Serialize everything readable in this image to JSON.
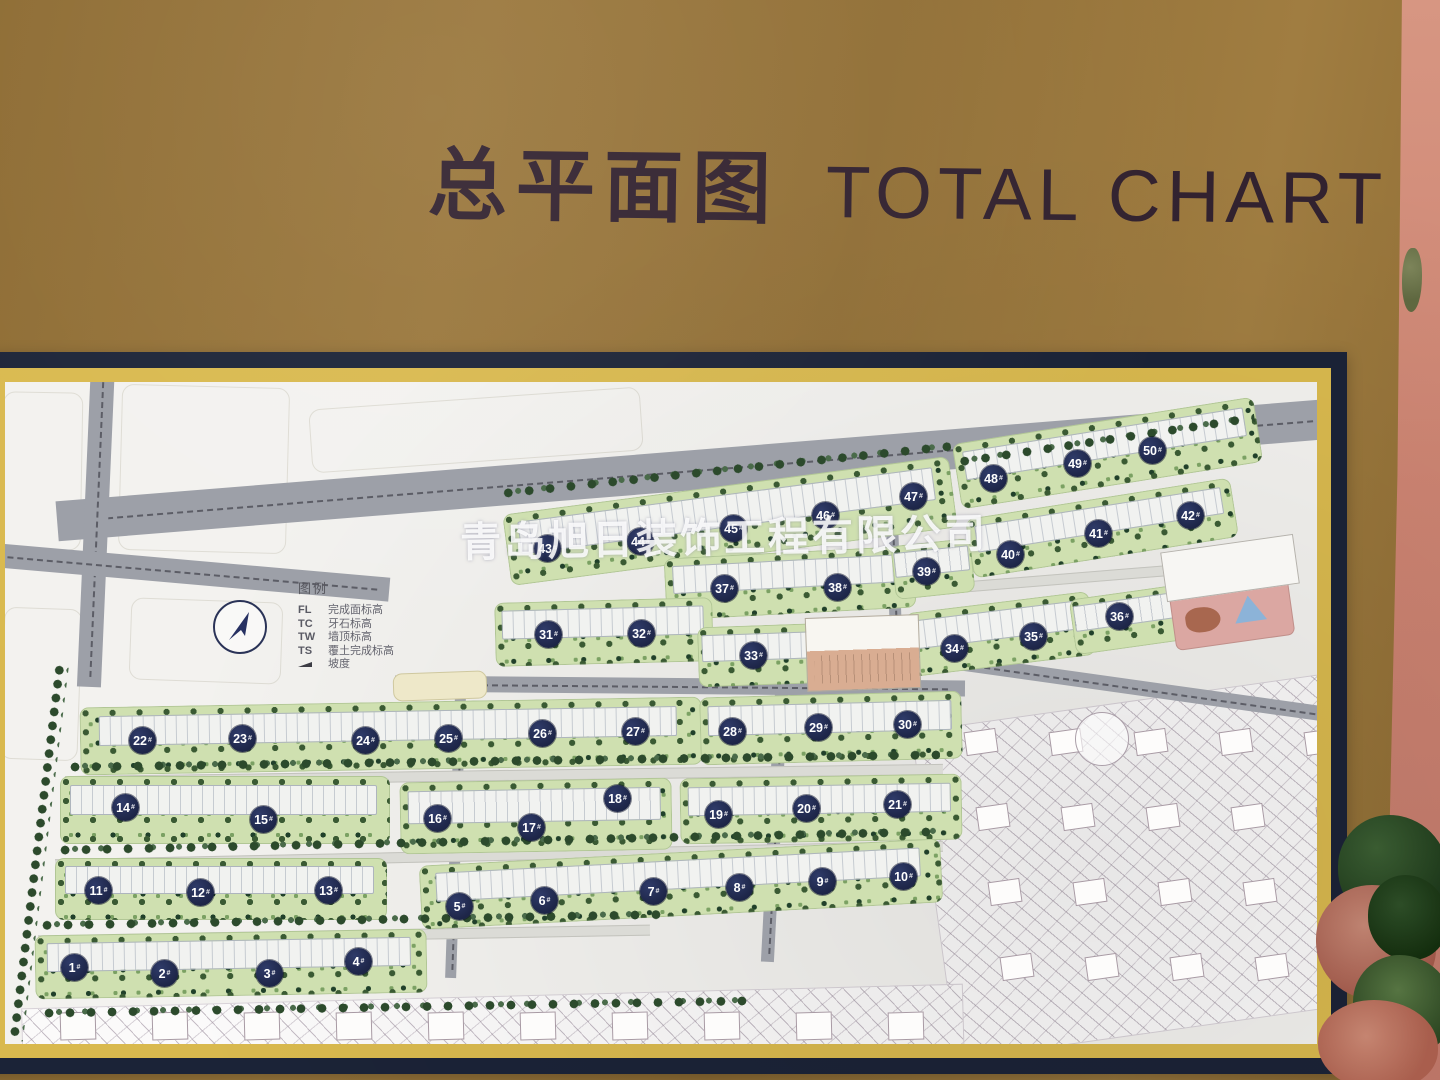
{
  "title": {
    "zh": "总平面图",
    "en": "TOTAL CHART"
  },
  "watermark": {
    "text": "青岛旭日装饰工程有限公司"
  },
  "legend": {
    "title": "图例",
    "items": [
      {
        "key": "FL",
        "label": "完成面标高"
      },
      {
        "key": "TC",
        "label": "牙石标高"
      },
      {
        "key": "TW",
        "label": "墙顶标高"
      },
      {
        "key": "TS",
        "label": "覆土完成标高"
      },
      {
        "key": "",
        "label": "坡度"
      }
    ]
  },
  "colors": {
    "board_gold": "#97743a",
    "frame_navy": "#1b2337",
    "frame_gold": "#d9b94e",
    "map_background": "#f3f2ef",
    "road_gray": "#9da0a8",
    "green_block": "#cfe0b0",
    "tree_dark": "#2c4a2c",
    "badge_navy": "#222b52",
    "badge_text": "#ffffff",
    "wall_pink": "#cd8472",
    "watermark": "#ffffff"
  },
  "map": {
    "origin": {
      "x": 5,
      "y": 382
    },
    "badge_suffix": "#",
    "badges": [
      {
        "n": 1,
        "x": 74,
        "y": 967
      },
      {
        "n": 2,
        "x": 164,
        "y": 973
      },
      {
        "n": 3,
        "x": 269,
        "y": 973
      },
      {
        "n": 4,
        "x": 358,
        "y": 961
      },
      {
        "n": 5,
        "x": 459,
        "y": 906
      },
      {
        "n": 6,
        "x": 544,
        "y": 900
      },
      {
        "n": 7,
        "x": 653,
        "y": 891
      },
      {
        "n": 8,
        "x": 739,
        "y": 887
      },
      {
        "n": 9,
        "x": 822,
        "y": 881
      },
      {
        "n": 10,
        "x": 903,
        "y": 876
      },
      {
        "n": 11,
        "x": 98,
        "y": 890
      },
      {
        "n": 12,
        "x": 200,
        "y": 892
      },
      {
        "n": 13,
        "x": 328,
        "y": 890
      },
      {
        "n": 14,
        "x": 125,
        "y": 807
      },
      {
        "n": 15,
        "x": 263,
        "y": 819
      },
      {
        "n": 16,
        "x": 437,
        "y": 818
      },
      {
        "n": 17,
        "x": 531,
        "y": 827
      },
      {
        "n": 18,
        "x": 617,
        "y": 798
      },
      {
        "n": 19,
        "x": 718,
        "y": 814
      },
      {
        "n": 20,
        "x": 806,
        "y": 808
      },
      {
        "n": 21,
        "x": 897,
        "y": 804
      },
      {
        "n": 22,
        "x": 142,
        "y": 740
      },
      {
        "n": 23,
        "x": 242,
        "y": 738
      },
      {
        "n": 24,
        "x": 365,
        "y": 740
      },
      {
        "n": 25,
        "x": 448,
        "y": 738
      },
      {
        "n": 26,
        "x": 542,
        "y": 733
      },
      {
        "n": 27,
        "x": 635,
        "y": 731
      },
      {
        "n": 28,
        "x": 732,
        "y": 731
      },
      {
        "n": 29,
        "x": 818,
        "y": 727
      },
      {
        "n": 30,
        "x": 907,
        "y": 724
      },
      {
        "n": 31,
        "x": 548,
        "y": 634
      },
      {
        "n": 32,
        "x": 641,
        "y": 633
      },
      {
        "n": 33,
        "x": 753,
        "y": 655
      },
      {
        "n": 34,
        "x": 954,
        "y": 648
      },
      {
        "n": 35,
        "x": 1033,
        "y": 636
      },
      {
        "n": 36,
        "x": 1119,
        "y": 616
      },
      {
        "n": 37,
        "x": 724,
        "y": 588
      },
      {
        "n": 38,
        "x": 837,
        "y": 587
      },
      {
        "n": 39,
        "x": 926,
        "y": 571
      },
      {
        "n": 40,
        "x": 1010,
        "y": 554
      },
      {
        "n": 41,
        "x": 1098,
        "y": 533
      },
      {
        "n": 42,
        "x": 1190,
        "y": 515
      },
      {
        "n": 43,
        "x": 547,
        "y": 548
      },
      {
        "n": 44,
        "x": 640,
        "y": 541
      },
      {
        "n": 45,
        "x": 733,
        "y": 528
      },
      {
        "n": 46,
        "x": 825,
        "y": 515
      },
      {
        "n": 47,
        "x": 913,
        "y": 496
      },
      {
        "n": 48,
        "x": 993,
        "y": 478
      },
      {
        "n": 49,
        "x": 1077,
        "y": 463
      },
      {
        "n": 50,
        "x": 1152,
        "y": 450
      }
    ],
    "parcels": [
      {
        "x": 2,
        "y": 392,
        "w": 78,
        "h": 156,
        "r": 1
      },
      {
        "x": 120,
        "y": 386,
        "w": 166,
        "h": 164,
        "r": 1.5
      },
      {
        "x": 2,
        "y": 608,
        "w": 76,
        "h": 150,
        "r": 2
      },
      {
        "x": 130,
        "y": 600,
        "w": 150,
        "h": 80,
        "r": 2
      },
      {
        "x": 310,
        "y": 398,
        "w": 330,
        "h": 62,
        "r": -4
      }
    ],
    "hatch_areas": [
      {
        "x": 932,
        "y": 700,
        "w": 430,
        "h": 330,
        "r": -8
      },
      {
        "x": 22,
        "y": 996,
        "w": 940,
        "h": 80,
        "r": -1.5
      }
    ],
    "hatch_house_grids": [
      {
        "x": 60,
        "y": 1012,
        "cols": 10,
        "rows": 1,
        "dx": 92,
        "dy": 0,
        "row_dx": 0,
        "w": 34,
        "h": 26,
        "r": -1.5
      },
      {
        "x": 965,
        "y": 730,
        "cols": 5,
        "rows": 4,
        "dx": 85,
        "dy": 75,
        "row_dx": 12,
        "w": 30,
        "h": 22,
        "r": -8
      }
    ],
    "circle_features": [
      {
        "x": 1075,
        "y": 712,
        "w": 52,
        "h": 52
      }
    ],
    "roads": [
      {
        "x": 55,
        "y": 448,
        "w": 1330,
        "h": 40,
        "r": -4.6,
        "v": 0
      },
      {
        "x": 84,
        "y": 362,
        "w": 24,
        "h": 325,
        "r": 2.5,
        "v": 1
      },
      {
        "x": -15,
        "y": 560,
        "w": 405,
        "h": 24,
        "r": 5,
        "v": 0
      },
      {
        "x": 395,
        "y": 678,
        "w": 570,
        "h": 16,
        "r": 0.5,
        "v": 0
      },
      {
        "x": 940,
        "y": 682,
        "w": 420,
        "h": 15,
        "r": 8,
        "v": 0
      },
      {
        "x": 768,
        "y": 690,
        "w": 13,
        "h": 272,
        "r": 3,
        "v": 1
      },
      {
        "x": 450,
        "y": 698,
        "w": 11,
        "h": 280,
        "r": 2,
        "v": 1
      },
      {
        "x": 888,
        "y": 472,
        "w": 12,
        "h": 212,
        "r": -2,
        "v": 1
      }
    ],
    "lanes": [
      {
        "x": 65,
        "y": 770,
        "w": 878,
        "h": 9,
        "r": -0.8
      },
      {
        "x": 55,
        "y": 850,
        "w": 888,
        "h": 9,
        "r": -1.2
      },
      {
        "x": 38,
        "y": 930,
        "w": 612,
        "h": 9,
        "r": -1
      },
      {
        "x": 495,
        "y": 589,
        "w": 752,
        "h": 9,
        "r": -4.6
      }
    ],
    "green_blocks": [
      {
        "x": 505,
        "y": 485,
        "w": 450,
        "h": 72,
        "r": -7.5
      },
      {
        "x": 955,
        "y": 420,
        "w": 305,
        "h": 66,
        "r": -9
      },
      {
        "x": 665,
        "y": 552,
        "w": 250,
        "h": 62,
        "r": -3
      },
      {
        "x": 968,
        "y": 498,
        "w": 268,
        "h": 60,
        "r": -9
      },
      {
        "x": 495,
        "y": 600,
        "w": 218,
        "h": 64,
        "r": -1.5
      },
      {
        "x": 698,
        "y": 625,
        "w": 135,
        "h": 60,
        "r": -2
      },
      {
        "x": 908,
        "y": 602,
        "w": 185,
        "h": 64,
        "r": -7
      },
      {
        "x": 1072,
        "y": 592,
        "w": 108,
        "h": 56,
        "r": -8
      },
      {
        "x": 893,
        "y": 542,
        "w": 80,
        "h": 54,
        "r": -6
      },
      {
        "x": 80,
        "y": 702,
        "w": 622,
        "h": 68,
        "r": -1
      },
      {
        "x": 700,
        "y": 694,
        "w": 262,
        "h": 68,
        "r": -1.5
      },
      {
        "x": 60,
        "y": 776,
        "w": 330,
        "h": 68,
        "r": 0
      },
      {
        "x": 400,
        "y": 780,
        "w": 272,
        "h": 72,
        "r": -1
      },
      {
        "x": 680,
        "y": 776,
        "w": 282,
        "h": 66,
        "r": -1
      },
      {
        "x": 55,
        "y": 858,
        "w": 332,
        "h": 62,
        "r": 0
      },
      {
        "x": 420,
        "y": 852,
        "w": 522,
        "h": 64,
        "r": -3
      },
      {
        "x": 35,
        "y": 932,
        "w": 392,
        "h": 64,
        "r": -1
      }
    ],
    "tree_lines": [
      {
        "x": 68,
        "y": 754,
        "w": 872,
        "h": 13,
        "r": -0.8
      },
      {
        "x": 58,
        "y": 834,
        "w": 880,
        "h": 13,
        "r": -1.2
      },
      {
        "x": 40,
        "y": 913,
        "w": 622,
        "h": 13,
        "r": -1
      },
      {
        "x": 500,
        "y": 463,
        "w": 452,
        "h": 12,
        "r": -6
      },
      {
        "x": 956,
        "y": 433,
        "w": 300,
        "h": 12,
        "r": -8.5
      },
      {
        "x": 42,
        "y": 1000,
        "w": 712,
        "h": 13,
        "r": -1
      },
      {
        "x": 30,
        "y": 662,
        "w": 16,
        "h": 380,
        "r": 7
      }
    ],
    "facilities": [
      {
        "name": "commercial-center-building",
        "cls": "fac-commercial",
        "x": 806,
        "y": 616,
        "w": 112,
        "h": 72,
        "r": -2
      },
      {
        "name": "playground-area",
        "cls": "fac-playground",
        "x": 1172,
        "y": 585,
        "w": 118,
        "h": 56,
        "r": -8
      },
      {
        "name": "northeast-building",
        "cls": "fac-white",
        "x": 1163,
        "y": 543,
        "w": 132,
        "h": 48,
        "r": -8
      },
      {
        "name": "entrance-plaza",
        "cls": "fac-plaza",
        "x": 393,
        "y": 672,
        "w": 92,
        "h": 26,
        "r": -2
      }
    ]
  }
}
